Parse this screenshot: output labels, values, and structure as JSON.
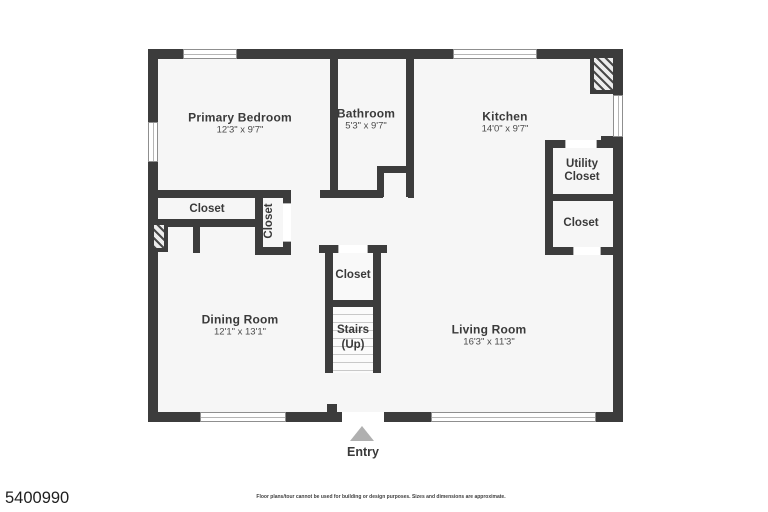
{
  "floorplan": {
    "rooms": {
      "primary_bedroom": {
        "name": "Primary Bedroom",
        "dims": "12'3\" x 9'7\""
      },
      "bathroom": {
        "name": "Bathroom",
        "dims": "5'3\" x 9'7\""
      },
      "kitchen": {
        "name": "Kitchen",
        "dims": "14'0\" x 9'7\""
      },
      "dining_room": {
        "name": "Dining Room",
        "dims": "12'1\" x 13'1\""
      },
      "living_room": {
        "name": "Living Room",
        "dims": "16'3\" x 11'3\""
      }
    },
    "labels": {
      "closet": "Closet",
      "utility_closet": "Utility Closet",
      "stairs": "Stairs",
      "stairs_direction": "(Up)",
      "entry": "Entry"
    },
    "colors": {
      "wall": "#3c3c3c",
      "room_fill": "#f6f6f6",
      "entry_arrow": "#b0b0b0"
    }
  },
  "footer": {
    "listing_id": "5400990",
    "disclaimer": "Floor plans/tour cannot be used for building or design purposes. Sizes and dimensions are approximate."
  }
}
